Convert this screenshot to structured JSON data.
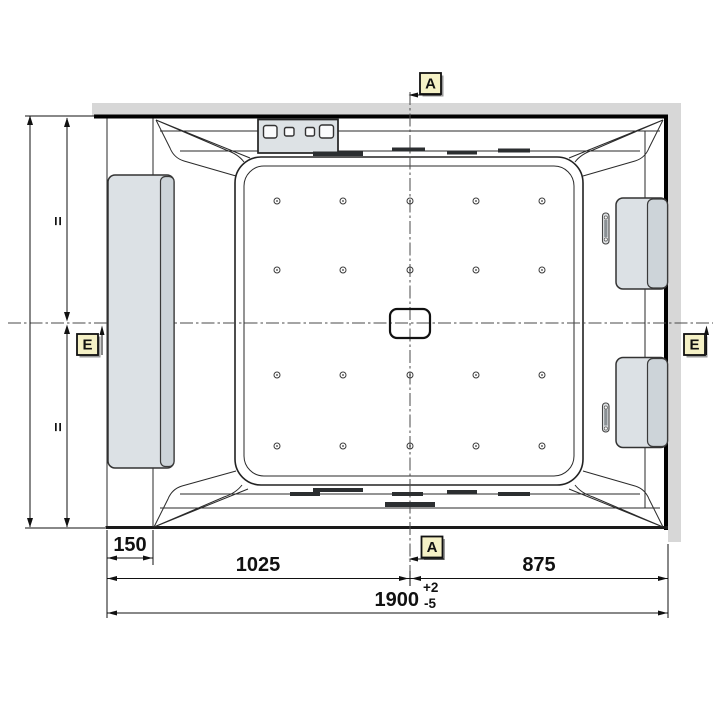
{
  "drawing": {
    "type": "bathtub-installation-top-view",
    "dims": {
      "left_inset": "150",
      "left_span": "1025",
      "right_span": "875",
      "overall_width": "1900",
      "tolerance_plus": "+2",
      "tolerance_minus": "-5",
      "equal_mark_upper": "=",
      "equal_mark_lower": "="
    },
    "markers": {
      "section_a": "A",
      "section_e": "E"
    },
    "colors": {
      "wall_fill": "#d7d7d7",
      "marker_fill": "#f5f1c6",
      "headrest_fill": "#dce1e5",
      "headrest_edge_fill": "#cdd4d9",
      "panel_fill": "#dde2e5",
      "basin_fill": "#ffffff"
    }
  }
}
